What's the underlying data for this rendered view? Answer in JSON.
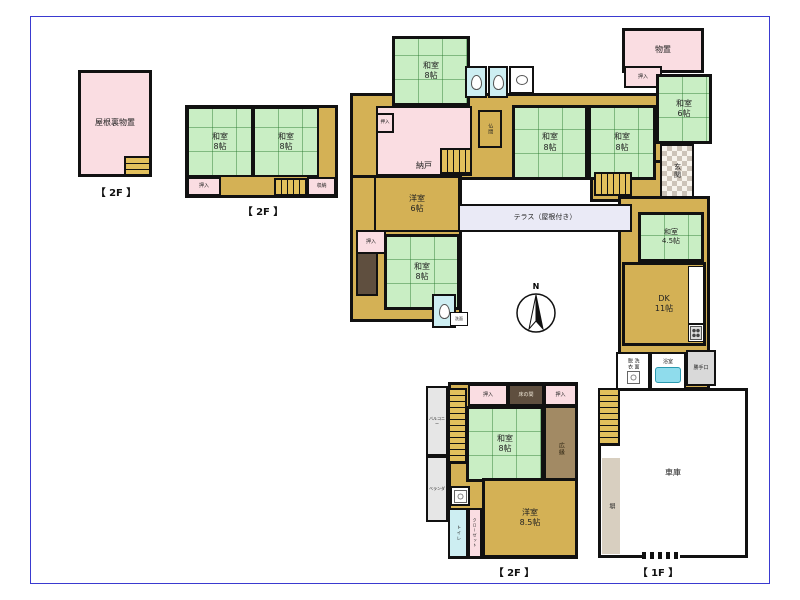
{
  "page": {
    "background": "#ffffff",
    "frame_color": "#3a3ad0"
  },
  "compass": {
    "label": "N"
  },
  "floor_labels": [
    {
      "id": "floor-label-attic-2f",
      "text": "【 2F 】",
      "x": 80,
      "y": 184,
      "w": 72
    },
    {
      "id": "floor-label-annex-2f",
      "text": "【 2F 】",
      "x": 222,
      "y": 203,
      "w": 82
    },
    {
      "id": "floor-label-south-2f",
      "text": "【 2F 】",
      "x": 462,
      "y": 564,
      "w": 104
    },
    {
      "id": "floor-label-main-1f",
      "text": "【 1F 】",
      "x": 606,
      "y": 564,
      "w": 104
    }
  ],
  "rooms": [
    {
      "id": "attic-storage",
      "type": "pink",
      "label": "屋根裏物置",
      "x": 78,
      "y": 70,
      "w": 74,
      "h": 107,
      "border": 3,
      "fs": 8
    },
    {
      "id": "attic-stairs",
      "type": "stairs-v",
      "x": 124,
      "y": 156,
      "w": 27,
      "h": 20,
      "border": 2
    },
    {
      "id": "annex2f-base",
      "type": "wood",
      "x": 185,
      "y": 105,
      "w": 153,
      "h": 93,
      "border": 3
    },
    {
      "id": "annex2f-washitsu-left",
      "type": "tatami",
      "label": "和室\n8帖",
      "x": 187,
      "y": 107,
      "w": 66,
      "h": 70,
      "border": 2,
      "fs": 8
    },
    {
      "id": "annex2f-washitsu-right",
      "type": "tatami",
      "label": "和室\n8帖",
      "x": 253,
      "y": 107,
      "w": 66,
      "h": 70,
      "border": 2,
      "fs": 8
    },
    {
      "id": "annex2f-oshiire",
      "type": "pink",
      "label": "押入",
      "x": 187,
      "y": 177,
      "w": 34,
      "h": 19,
      "border": 2,
      "fs": 5
    },
    {
      "id": "annex2f-stairs",
      "type": "stairs-h",
      "x": 274,
      "y": 178,
      "w": 33,
      "h": 18,
      "border": 2
    },
    {
      "id": "annex2f-shuno",
      "type": "pink",
      "label": "収納",
      "x": 307,
      "y": 177,
      "w": 29,
      "h": 19,
      "border": 2,
      "fs": 5
    },
    {
      "id": "main-hall-north",
      "type": "wood",
      "x": 350,
      "y": 93,
      "w": 318,
      "h": 87,
      "border": 3
    },
    {
      "id": "main-west-wing",
      "type": "wood",
      "x": 350,
      "y": 175,
      "w": 112,
      "h": 147,
      "border": 3
    },
    {
      "id": "main-genkan-hall",
      "type": "wood",
      "x": 590,
      "y": 160,
      "w": 78,
      "h": 42,
      "border": 3
    },
    {
      "id": "main-east-wing",
      "type": "wood",
      "x": 618,
      "y": 196,
      "w": 92,
      "h": 194,
      "border": 3
    },
    {
      "id": "south2f-base",
      "type": "wood",
      "x": 448,
      "y": 382,
      "w": 130,
      "h": 177,
      "border": 3
    },
    {
      "id": "washitsu8-north",
      "type": "tatami",
      "label": "和室\n8帖",
      "x": 392,
      "y": 36,
      "w": 78,
      "h": 70,
      "border": 3,
      "fs": 8
    },
    {
      "id": "wc-north-1",
      "type": "wc",
      "icon": "toilet",
      "x": 465,
      "y": 66,
      "w": 22,
      "h": 32,
      "border": 2
    },
    {
      "id": "wc-north-2",
      "type": "wc",
      "icon": "toilet",
      "x": 488,
      "y": 66,
      "w": 20,
      "h": 32,
      "border": 2
    },
    {
      "id": "sink-room-north",
      "type": "white",
      "icon": "sink",
      "x": 509,
      "y": 66,
      "w": 25,
      "h": 28,
      "border": 2
    },
    {
      "id": "monooki",
      "type": "pink",
      "label": "物置",
      "x": 622,
      "y": 28,
      "w": 82,
      "h": 45,
      "border": 3,
      "fs": 8
    },
    {
      "id": "oshiire-ne",
      "type": "pink",
      "label": "押入",
      "x": 624,
      "y": 66,
      "w": 38,
      "h": 22,
      "border": 2,
      "fs": 5
    },
    {
      "id": "washitsu6-ne",
      "type": "tatami",
      "label": "和室\n6帖",
      "x": 656,
      "y": 74,
      "w": 56,
      "h": 70,
      "border": 3,
      "fs": 8
    },
    {
      "id": "genkan",
      "type": "checker",
      "label": "玄関",
      "vertical": true,
      "x": 660,
      "y": 144,
      "w": 34,
      "h": 54,
      "border": 2,
      "fs": 7
    },
    {
      "id": "nando",
      "type": "pink",
      "label": "納戸",
      "x": 376,
      "y": 106,
      "w": 96,
      "h": 70,
      "border": 2,
      "fs": 8,
      "valign": "end"
    },
    {
      "id": "nando-stairs",
      "type": "stairs-h",
      "x": 440,
      "y": 148,
      "w": 32,
      "h": 26,
      "border": 2
    },
    {
      "id": "oshiire-nando",
      "type": "pink",
      "label": "押入",
      "x": 376,
      "y": 113,
      "w": 18,
      "h": 20,
      "border": 2,
      "fs": 4.5
    },
    {
      "id": "butsuma",
      "type": "wood",
      "label": "仏間",
      "vertical": true,
      "x": 478,
      "y": 110,
      "w": 24,
      "h": 38,
      "border": 2,
      "fs": 5
    },
    {
      "id": "washitsu8-center-west",
      "type": "tatami",
      "label": "和室\n8帖",
      "x": 512,
      "y": 105,
      "w": 76,
      "h": 75,
      "border": 3,
      "fs": 8
    },
    {
      "id": "washitsu8-center-east",
      "type": "tatami",
      "label": "和室\n8帖",
      "x": 588,
      "y": 105,
      "w": 68,
      "h": 75,
      "border": 3,
      "fs": 8
    },
    {
      "id": "genkan-stairs",
      "type": "stairs-h",
      "x": 594,
      "y": 172,
      "w": 38,
      "h": 24,
      "border": 2
    },
    {
      "id": "yoshitsu6",
      "type": "wood",
      "label": "洋室\n6帖",
      "x": 374,
      "y": 176,
      "w": 86,
      "h": 56,
      "border": 2,
      "fs": 8
    },
    {
      "id": "oshiire-west",
      "type": "pink",
      "label": "押入",
      "x": 356,
      "y": 230,
      "w": 30,
      "h": 24,
      "border": 2,
      "fs": 5
    },
    {
      "id": "tokonoma-west",
      "type": "dark",
      "x": 356,
      "y": 252,
      "w": 22,
      "h": 44,
      "border": 2
    },
    {
      "id": "washitsu8-west",
      "type": "tatami",
      "label": "和室\n8帖",
      "x": 384,
      "y": 234,
      "w": 76,
      "h": 76,
      "border": 3,
      "fs": 8
    },
    {
      "id": "wc-mid",
      "type": "wc",
      "icon": "toilet",
      "x": 432,
      "y": 294,
      "w": 24,
      "h": 34,
      "border": 2
    },
    {
      "id": "senmen-mid",
      "type": "white",
      "label": "洗面",
      "x": 450,
      "y": 312,
      "w": 18,
      "h": 14,
      "border": 1,
      "fs": 4
    },
    {
      "id": "terrace",
      "type": "terrace",
      "label": "テラス（屋根付き）",
      "x": 458,
      "y": 204,
      "w": 174,
      "h": 28,
      "border": 2,
      "fs": 7
    },
    {
      "id": "washitsu45",
      "type": "tatami",
      "label": "和室\n4.5帖",
      "x": 638,
      "y": 212,
      "w": 66,
      "h": 50,
      "border": 3,
      "fs": 7
    },
    {
      "id": "dk",
      "type": "wood",
      "label": "DK\n11帖",
      "x": 622,
      "y": 262,
      "w": 84,
      "h": 84,
      "border": 3,
      "fs": 8
    },
    {
      "id": "kitchen-counter",
      "type": "white",
      "x": 688,
      "y": 266,
      "w": 16,
      "h": 58,
      "border": 1
    },
    {
      "id": "kitchen-stove",
      "type": "white",
      "icon": "stove",
      "x": 688,
      "y": 324,
      "w": 16,
      "h": 18,
      "border": 1
    },
    {
      "id": "senmen-datsui",
      "type": "white",
      "label": "洗面\n脱衣",
      "vertical": true,
      "icon": "washer",
      "x": 616,
      "y": 352,
      "w": 34,
      "h": 38,
      "border": 2,
      "fs": 5
    },
    {
      "id": "yokushitsu",
      "type": "white",
      "label": "浴室",
      "icon": "tub",
      "x": 650,
      "y": 352,
      "w": 36,
      "h": 38,
      "border": 2,
      "fs": 5
    },
    {
      "id": "katteguchi",
      "type": "gray",
      "label": "勝手口",
      "x": 686,
      "y": 350,
      "w": 30,
      "h": 36,
      "border": 2,
      "fs": 5
    },
    {
      "id": "garage",
      "type": "white",
      "label": "車庫",
      "x": 598,
      "y": 388,
      "w": 150,
      "h": 170,
      "border": 3,
      "fs": 8
    },
    {
      "id": "garage-stairs",
      "type": "stairs-v",
      "x": 598,
      "y": 388,
      "w": 22,
      "h": 58,
      "border": 2
    },
    {
      "id": "hei-fence",
      "type": "beige",
      "label": "塀",
      "vertical": true,
      "x": 602,
      "y": 458,
      "w": 18,
      "h": 96,
      "border": 0,
      "fs": 6
    },
    {
      "id": "garage-gate-hatch",
      "type": "hatch",
      "x": 642,
      "y": 552,
      "w": 38,
      "h": 7,
      "border": 0
    },
    {
      "id": "south-oshiire-west",
      "type": "pink",
      "label": "押入",
      "x": 468,
      "y": 384,
      "w": 40,
      "h": 22,
      "border": 2,
      "fs": 5
    },
    {
      "id": "south-tokonoma",
      "type": "dark",
      "label": "床の間",
      "x": 508,
      "y": 384,
      "w": 36,
      "h": 22,
      "border": 2,
      "fs": 5,
      "label_color": "#f0e8d8"
    },
    {
      "id": "south-oshiire-east",
      "type": "pink",
      "label": "押入",
      "x": 544,
      "y": 384,
      "w": 33,
      "h": 22,
      "border": 2,
      "fs": 5
    },
    {
      "id": "south-washitsu8",
      "type": "tatami",
      "label": "和室\n8帖",
      "x": 466,
      "y": 406,
      "w": 78,
      "h": 76,
      "border": 3,
      "fs": 8
    },
    {
      "id": "south-hiroen",
      "type": "brown",
      "label": "広縁",
      "vertical": true,
      "x": 544,
      "y": 406,
      "w": 33,
      "h": 86,
      "border": 2,
      "fs": 6,
      "label_color": "#2f2613"
    },
    {
      "id": "south-stairs",
      "type": "stairs-v",
      "x": 448,
      "y": 388,
      "w": 19,
      "h": 76,
      "border": 2
    },
    {
      "id": "south-sink",
      "type": "white",
      "icon": "washer",
      "x": 450,
      "y": 486,
      "w": 20,
      "h": 20,
      "border": 2
    },
    {
      "id": "south-toire",
      "type": "wc",
      "label": "トイレ",
      "vertical": true,
      "x": 448,
      "y": 508,
      "w": 20,
      "h": 50,
      "border": 2,
      "fs": 4.5
    },
    {
      "id": "south-closet",
      "type": "pink",
      "label": "クローゼット",
      "vertical": true,
      "x": 468,
      "y": 508,
      "w": 14,
      "h": 50,
      "border": 2,
      "fs": 4
    },
    {
      "id": "south-yoshitsu85",
      "type": "wood",
      "label": "洋室\n8.5帖",
      "x": 482,
      "y": 478,
      "w": 96,
      "h": 80,
      "border": 3,
      "fs": 8
    },
    {
      "id": "balcony-north",
      "type": "graylight",
      "label": "バルコニー",
      "x": 426,
      "y": 386,
      "w": 22,
      "h": 70,
      "border": 2,
      "fs": 4
    },
    {
      "id": "balcony-south",
      "type": "graylight",
      "label": "ベランダ",
      "x": 426,
      "y": 456,
      "w": 22,
      "h": 66,
      "border": 2,
      "fs": 4
    }
  ]
}
